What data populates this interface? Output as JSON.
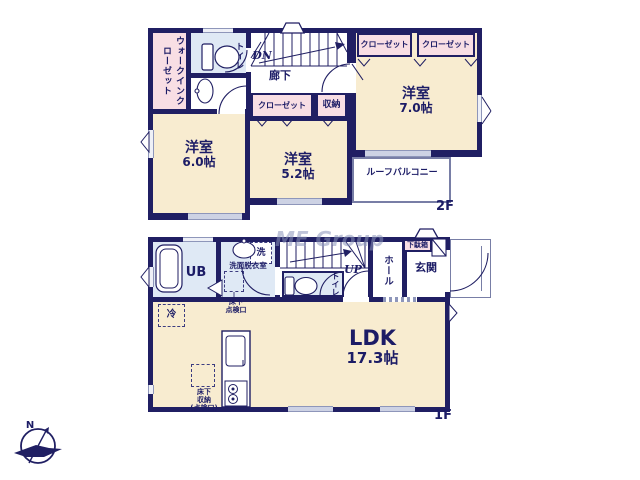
{
  "watermark": "ME Group",
  "compass": {
    "north": "N"
  },
  "floor2": {
    "wic": "ウォークインクローゼット",
    "toilet": "トイレ",
    "dn": "DN",
    "corridor": "廊下",
    "closet_center": "クローゼット",
    "storage": "収納",
    "closet_right1": "クローゼット",
    "closet_right2": "クローゼット",
    "bedroom6_name": "洋室",
    "bedroom6_size": "6.0帖",
    "bedroom5_name": "洋室",
    "bedroom5_size": "5.2帖",
    "bedroom7_name": "洋室",
    "bedroom7_size": "7.0帖",
    "balcony": "ルーフバルコニー",
    "floor_label": "2F"
  },
  "floor1": {
    "ub": "UB",
    "washroom": "洗面脱衣室",
    "laundry": "洗",
    "underfloor_hatch": "床下\n点検口",
    "toilet": "トイレ",
    "up": "UP",
    "hall": "ホール",
    "entrance": "玄関",
    "shoe_box": "下駄箱",
    "fridge": "冷",
    "ldk_name": "LDK",
    "ldk_size": "17.3帖",
    "underfloor_storage": "床下\n収納\n(点検口)",
    "floor_label": "1F"
  },
  "colors": {
    "wall": "#201f63",
    "room": "#f8ecd0",
    "closet": "#f8dee4",
    "wet": "#dfe9f5",
    "text": "#1c1c66"
  }
}
